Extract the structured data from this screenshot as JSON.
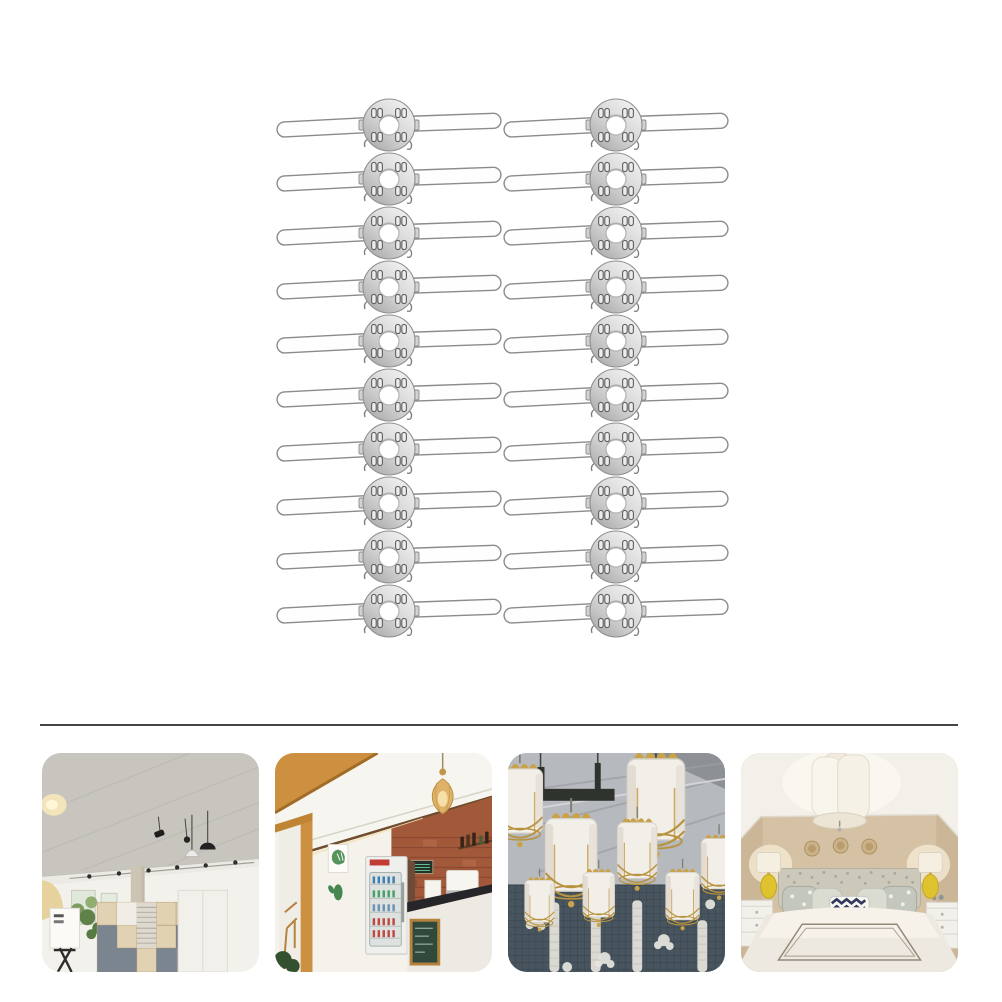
{
  "page": {
    "background": "#ffffff",
    "content": "product photo collage of 20 metal lamp-shade crossbar clips above four interior inspiration photos"
  },
  "product_grid": {
    "item_name": "lamp-shade-butterfly-wire-clip",
    "item_count": 20,
    "columns": 2,
    "rows": 10,
    "column_centers_x": [
      389,
      616
    ],
    "first_row_center_y": 125,
    "row_spacing_y": 54,
    "clip": {
      "overall_width": 224,
      "disc_radius": 26,
      "hole_radius": 10,
      "wing_length": 94,
      "wing_thickness": 15
    }
  },
  "divider": {
    "x1": 40,
    "x2": 958,
    "y": 724,
    "thickness": 2,
    "color": "#454545"
  },
  "thumbnails": [
    {
      "name": "office-interior",
      "description": "Bright studio office: concrete ceiling, track spotlights, pendant lamps, cube shelving"
    },
    {
      "name": "cafe-interior",
      "description": "Cafe corner: wooden beam, brick wall, drinks fridge, woven rattan pendant lamp"
    },
    {
      "name": "lantern-display",
      "description": "White fabric lanterns with gold frames hanging from an industrial metal ceiling"
    },
    {
      "name": "bedroom-interior",
      "description": "Beige bedroom: white cylinder ceiling lamp, patterned pillows, yellow table lamps"
    }
  ],
  "palette": {
    "metal_light": "#f2f2f2",
    "metal_mid": "#d6d6d6",
    "metal_dark": "#a9a9a9",
    "metal_outline": "#8b8b8b",
    "divider": "#454545",
    "wood": "#cd9041",
    "brick": "#a2593a",
    "lantern_gold": "#c9a24a",
    "bedroom_wall": "#d5c2a4",
    "lamp_yellow": "#dec32f"
  }
}
